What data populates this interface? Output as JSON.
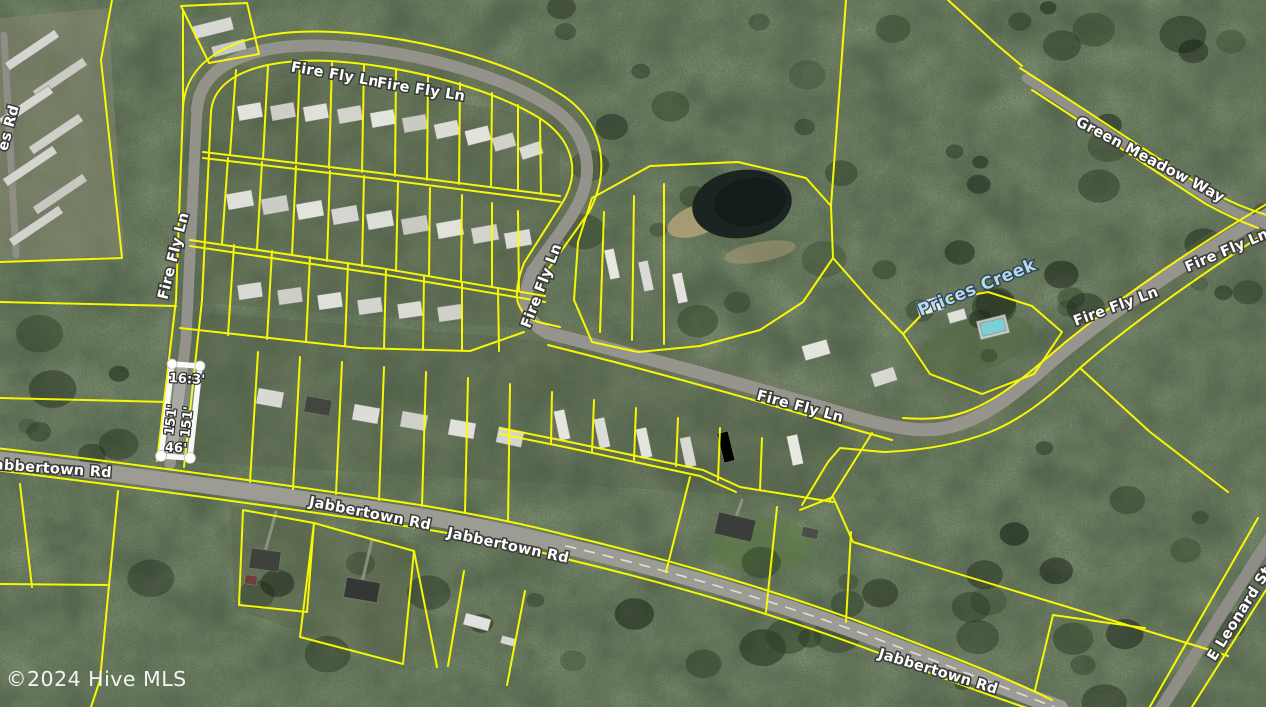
{
  "map": {
    "attribution": "©2024 Hive MLS",
    "labels": {
      "fire_fly_ln": "Fire Fly Ln",
      "jabbertown_rd": "Jabbertown Rd",
      "green_meadow_way": "Green Meadow Way",
      "e_leonard_st": "E Leonard St",
      "partial_road_left": "es Rd",
      "creek": "Prices Creek"
    },
    "parcel_highlight": {
      "top": "16:3'",
      "left": "151'",
      "right": "151'",
      "bottom": "46'"
    },
    "colors": {
      "parcel_line": "#ffff00",
      "road_label_text": "#ffffff",
      "creek_label_text": "#b5d8ea",
      "highlight": "#ffffff",
      "attribution_text": "#ffffff"
    }
  }
}
